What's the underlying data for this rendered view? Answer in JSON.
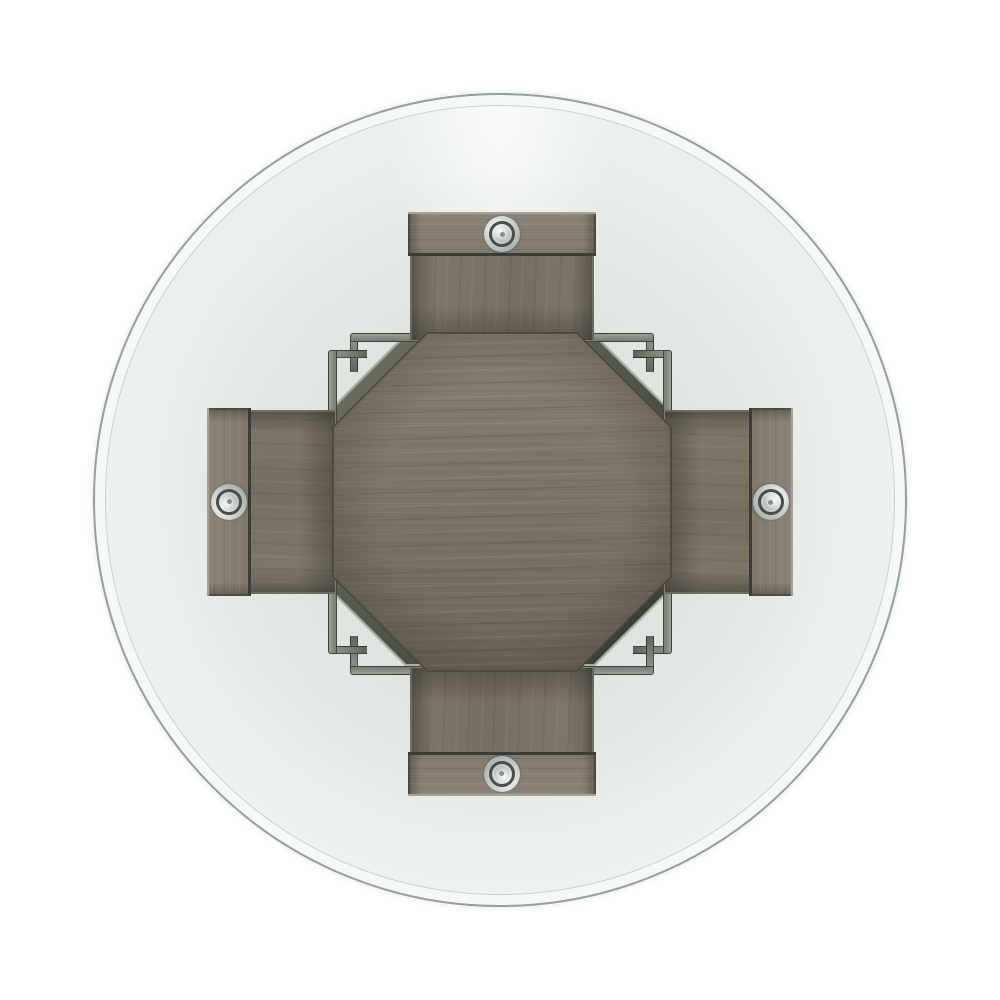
{
  "scene": {
    "type": "product-photo",
    "subject": "Overhead view of a round beveled-glass-top table on a gray wood pedestal base with four legs",
    "glass_shape": "circle",
    "pedestal_shape": "octagon",
    "legs_visible": 4,
    "metal_fasteners_visible": 4
  },
  "colors": {
    "background": "#ffffff",
    "glass_edge": "#94a09c",
    "glass_bevel": "#f5f9f6",
    "glass_center": "#e7ede9",
    "glass_rim": "#eff4f1",
    "wood_base": "#7b7367",
    "wood_light": "#857d70",
    "wood_dark": "#6d665a",
    "wood_rim": "#4d483e",
    "leg_face": "#80786b",
    "leg_cap": "#8b8376",
    "cap_edge_light": "#a8a193",
    "seam_dark": "#3a3d35",
    "chamfer_light": "#6e7265",
    "chamfer_dark": "#3c3f38",
    "tier_edge_light": "#a9afa1",
    "shoulder_top": "#99a094",
    "shoulder_side": "#5f6459",
    "metal_bright": "#f4f6f4",
    "metal_mid": "#ccd1ce",
    "metal_shadow": "#878d8a",
    "metal_ring_dark": "#4a4e4a"
  }
}
